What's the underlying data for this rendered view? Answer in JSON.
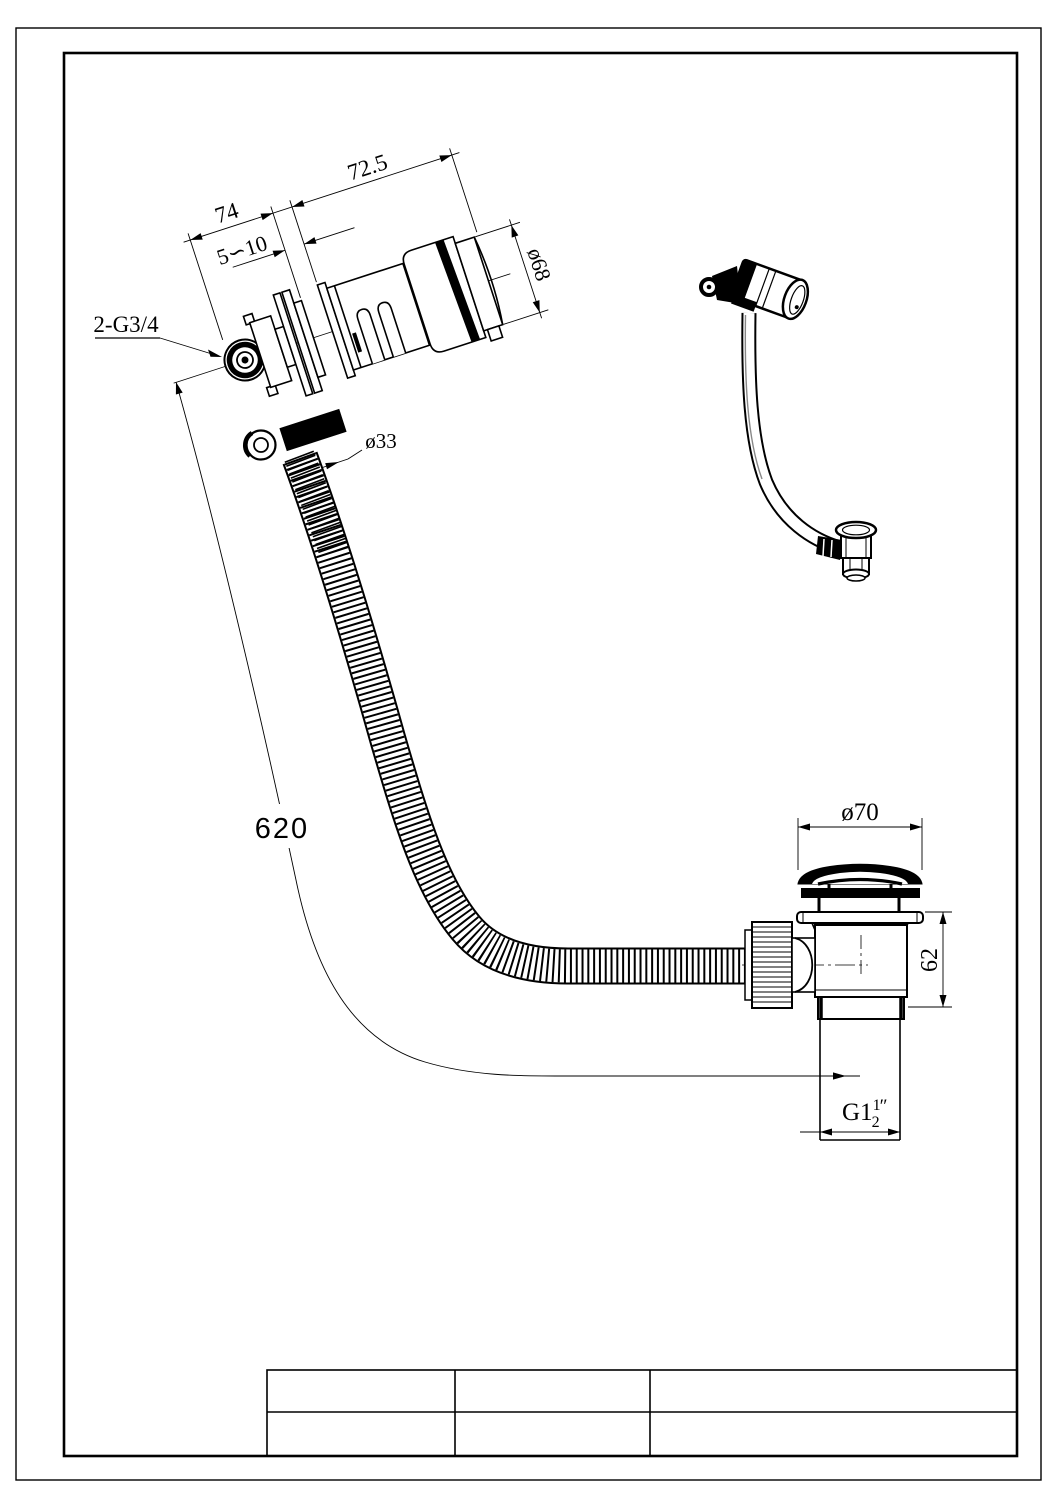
{
  "drawing": {
    "overflow_detail": {
      "dim_chain_left": "74",
      "dim_chain_right": "72.5",
      "dim_wall_gap": "5∽10",
      "dim_cap_diameter": "ø68",
      "label_inlet_thread": "2-G3/4",
      "dim_hose_diameter": "ø33"
    },
    "hose": {
      "dim_length": "620"
    },
    "waste_detail": {
      "dim_cap_diameter": "ø70",
      "dim_body_height": "62",
      "outlet_thread": {
        "prefix": "G1",
        "frac_numerator": "1",
        "frac_denominator": "2",
        "unit_mark": "″"
      }
    },
    "title_block": {
      "rows": 2,
      "columns": 3,
      "cells": [
        "",
        "",
        "",
        "",
        "",
        ""
      ]
    },
    "colors": {
      "line": "#000000",
      "background": "#ffffff",
      "hose_length_text": "#4a4a4a"
    }
  }
}
